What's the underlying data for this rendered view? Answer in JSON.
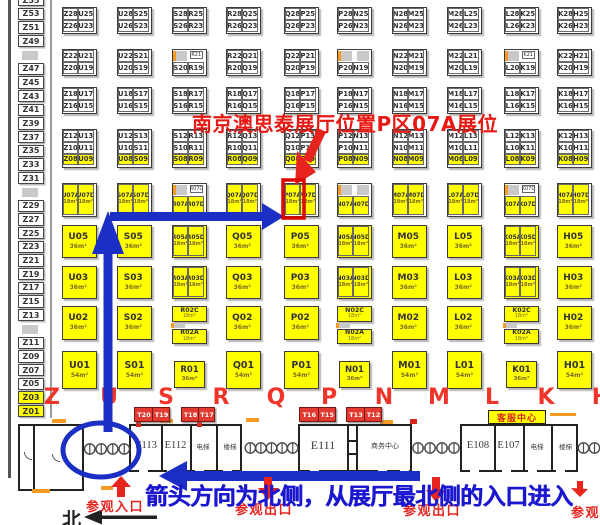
{
  "colors": {
    "booth_yellow": "#ffff00",
    "booth_border": "#3c3c3c",
    "gray_block": "#c9c9c9",
    "orange_mark": "#f59a23",
    "annotation_red": "#e8241f",
    "annotation_blue": "#1b2fc4",
    "letter_red": "#f0352b",
    "t_booth_red": "#e23a30"
  },
  "annotations": {
    "callout": "南京澳思泰展厅位置P区07A展位",
    "direction_note": "箭头方向为北侧，从展厅最北侧的入口进入",
    "entrance": "参观入口",
    "exit": "参观出口",
    "north": "北",
    "highlighted_booth": "P07A"
  },
  "z_column": [
    "Z55",
    "Z53",
    "Z51",
    "Z49",
    null,
    "Z47",
    "Z45",
    "Z43",
    "Z41",
    "Z39",
    "Z37",
    "Z35",
    "Z33",
    "Z31",
    null,
    "Z29",
    "Z27",
    "Z25",
    "Z23",
    "Z21",
    "Z19",
    "Z17",
    "Z15",
    "Z13",
    null,
    "Z11",
    "Z09",
    "Z07",
    "Z05",
    "Z03",
    "Z01"
  ],
  "grid": {
    "column_letters": [
      "Z",
      "U",
      "S",
      "R",
      "Q",
      "P",
      "N",
      "M",
      "L",
      "K",
      "H"
    ],
    "row1": [
      {
        "cells": [
          "Z28",
          "U25",
          "Z26",
          "U23"
        ]
      },
      {
        "cells": [
          "U28",
          "S25",
          "U26",
          "S23"
        ]
      },
      {
        "cells": [
          "S28",
          "R25",
          "S26",
          "R23"
        ]
      },
      {
        "cells": [
          "R28",
          "Q25",
          "R26",
          "Q23"
        ]
      },
      {
        "cells": [
          "Q28",
          "P25",
          "Q26",
          "P23"
        ]
      },
      {
        "cells": [
          "P28",
          "N25",
          "P26",
          "N23"
        ]
      },
      {
        "cells": [
          "N28",
          "M25",
          "N26",
          "M23"
        ]
      },
      {
        "cells": [
          "M28",
          "L25",
          "M26",
          "L23"
        ]
      },
      {
        "cells": [
          "L28",
          "K25",
          "L26",
          "K23"
        ]
      },
      {
        "cells": [
          "K28",
          "H25",
          "K26",
          "H23"
        ]
      }
    ],
    "row2": [
      {
        "cells": [
          "Z22",
          "U21",
          "Z20",
          "U19"
        ]
      },
      {
        "cells": [
          "U22",
          "S21",
          "U20",
          "S19"
        ]
      },
      {
        "cells": [
          null,
          null,
          "S20",
          "R19"
        ],
        "gray": [
          0
        ],
        "tag": "R21"
      },
      {
        "cells": [
          "R22",
          "Q21",
          "R20",
          "Q19"
        ]
      },
      {
        "cells": [
          "Q22",
          "P21",
          "Q20",
          "P19"
        ]
      },
      {
        "cells": [
          null,
          null,
          "P20",
          "N19"
        ],
        "gray": [
          0,
          1
        ]
      },
      {
        "cells": [
          "N22",
          "M21",
          "N20",
          "M19"
        ]
      },
      {
        "cells": [
          "M22",
          "L21",
          "M20",
          "L19"
        ]
      },
      {
        "cells": [
          null,
          null,
          "L20",
          "K19"
        ],
        "gray": [
          0
        ],
        "tag": "K21"
      },
      {
        "cells": [
          "K22",
          "H21",
          "K20",
          "H19"
        ]
      }
    ],
    "row3": [
      {
        "cells": [
          "Z18",
          "U17",
          "Z16",
          "U15"
        ]
      },
      {
        "cells": [
          "U18",
          "S17",
          "U16",
          "S15"
        ]
      },
      {
        "cells": [
          "S18",
          "R17",
          "S16",
          "R15"
        ]
      },
      {
        "cells": [
          "R18",
          "Q17",
          "R16",
          "Q15"
        ]
      },
      {
        "cells": [
          "Q18",
          "P17",
          "Q16",
          "P15"
        ]
      },
      {
        "cells": [
          "P18",
          "N17",
          "P16",
          "N15"
        ]
      },
      {
        "cells": [
          "N18",
          "M17",
          "N16",
          "M15"
        ]
      },
      {
        "cells": [
          "M18",
          "L17",
          "M16",
          "L15"
        ]
      },
      {
        "cells": [
          "L18",
          "K17",
          "L16",
          "K15"
        ]
      },
      {
        "cells": [
          "K18",
          "H17",
          "K16",
          "H15"
        ]
      }
    ],
    "row4": [
      {
        "cells": [
          "Z12",
          "U13",
          "Z10",
          "U11",
          "Z08",
          "U09"
        ]
      },
      {
        "cells": [
          "U12",
          "S13",
          "U10",
          "S11",
          "U08",
          "S09"
        ]
      },
      {
        "cells": [
          "S12",
          "R13",
          "S10",
          "R11",
          "S08",
          "R09"
        ]
      },
      {
        "cells": [
          "R12",
          "Q13",
          "R10",
          "Q11",
          "R08",
          "Q09"
        ]
      },
      {
        "cells": [
          "Q12",
          "P13",
          "Q10",
          "P11",
          "Q08",
          "P09"
        ]
      },
      {
        "cells": [
          "P12",
          "N13",
          "P10",
          "N11",
          "P08",
          "N09"
        ]
      },
      {
        "cells": [
          "N12",
          "M13",
          "N10",
          "M11",
          "N08",
          "M09"
        ]
      },
      {
        "cells": [
          "M12",
          "L13",
          "M10",
          "L11",
          "M08",
          "L09"
        ]
      },
      {
        "cells": [
          "L12",
          "K13",
          "L10",
          "K11",
          "L08",
          "K09"
        ]
      },
      {
        "cells": [
          "K12",
          "H13",
          "K10",
          "H11",
          "K08",
          "H09"
        ]
      }
    ],
    "row5": [
      {
        "t": "pair",
        "a": "U07A",
        "d": "U07D",
        "area": "18m²"
      },
      {
        "t": "pair",
        "a": "S07A",
        "d": "S07D",
        "area": "18m²"
      },
      {
        "t": "graytop",
        "tag": "R07C",
        "a": "R07A",
        "d": "R07D"
      },
      {
        "t": "pair",
        "a": "Q07A",
        "d": "Q07D",
        "area": "18m²"
      },
      {
        "t": "pair",
        "a": "P07A",
        "d": "P07D",
        "area": "18m²",
        "highlight": true
      },
      {
        "t": "graytop2",
        "a": "N07A",
        "d": "N07D"
      },
      {
        "t": "pair",
        "a": "M07A",
        "d": "M07D",
        "area": "18m²"
      },
      {
        "t": "pair",
        "a": "L07A",
        "d": "L07D",
        "area": "18m²"
      },
      {
        "t": "graytop",
        "tag": "K07C",
        "a": "K07A",
        "d": "K07D"
      },
      {
        "t": "pair",
        "a": "H07A",
        "d": "H07D",
        "area": "18m²"
      }
    ],
    "row6": [
      {
        "t": "single",
        "l": "U05",
        "area": "36m²"
      },
      {
        "t": "single",
        "l": "S05",
        "area": "36m²"
      },
      {
        "t": "pair",
        "a": "R05A",
        "d": "R05D",
        "area": "18m²"
      },
      {
        "t": "single",
        "l": "Q05",
        "area": "36m²"
      },
      {
        "t": "single",
        "l": "P05",
        "area": "36m²"
      },
      {
        "t": "pair",
        "a": "N05A",
        "d": "N05D",
        "area": "18m²"
      },
      {
        "t": "single",
        "l": "M05",
        "area": "36m²"
      },
      {
        "t": "single",
        "l": "L05",
        "area": "36m²"
      },
      {
        "t": "pair",
        "a": "K05A",
        "d": "K05D",
        "area": "18m²"
      },
      {
        "t": "single",
        "l": "H05",
        "area": "36m²"
      }
    ],
    "row7": [
      {
        "t": "single",
        "l": "U03",
        "area": "36m²"
      },
      {
        "t": "single",
        "l": "S03",
        "area": "36m²"
      },
      {
        "t": "pair",
        "a": "R03A",
        "d": "R03D",
        "area": "18m²"
      },
      {
        "t": "single",
        "l": "Q03",
        "area": "36m²"
      },
      {
        "t": "single",
        "l": "P03",
        "area": "36m²"
      },
      {
        "t": "pair",
        "a": "N03A",
        "d": "N03D",
        "area": "18m²"
      },
      {
        "t": "single",
        "l": "M03",
        "area": "36m²"
      },
      {
        "t": "single",
        "l": "L03",
        "area": "36m²"
      },
      {
        "t": "pair",
        "a": "K03A",
        "d": "K03D",
        "area": "18m²"
      },
      {
        "t": "single",
        "l": "H03",
        "area": "36m²"
      }
    ],
    "row8": [
      {
        "t": "single",
        "l": "U02",
        "area": "36m²"
      },
      {
        "t": "single",
        "l": "S02",
        "area": "36m²"
      },
      {
        "t": "stack",
        "top": "R02C",
        "bottom": "R02A",
        "area": "18m²"
      },
      {
        "t": "single",
        "l": "Q02",
        "area": "36m²"
      },
      {
        "t": "single",
        "l": "P02",
        "area": "36m²"
      },
      {
        "t": "stack",
        "top": "N02C",
        "bottom": "N02A",
        "area": "18m²"
      },
      {
        "t": "single",
        "l": "M02",
        "area": "36m²"
      },
      {
        "t": "single",
        "l": "L02",
        "area": "36m²"
      },
      {
        "t": "stack",
        "top": "K02C",
        "bottom": "K02A",
        "area": "18m²"
      },
      {
        "t": "single",
        "l": "H02",
        "area": "36m²"
      }
    ],
    "row9": [
      {
        "t": "single",
        "l": "U01",
        "area": "54m²"
      },
      {
        "t": "single",
        "l": "S01",
        "area": "54m²"
      },
      {
        "t": "small",
        "l": "R01",
        "area": "36m²"
      },
      {
        "t": "single",
        "l": "Q01",
        "area": "54m²"
      },
      {
        "t": "single",
        "l": "P01",
        "area": "54m²"
      },
      {
        "t": "small",
        "l": "N01",
        "area": "36m²"
      },
      {
        "t": "single",
        "l": "M01",
        "area": "54m²"
      },
      {
        "t": "single",
        "l": "L01",
        "area": "54m²"
      },
      {
        "t": "small",
        "l": "K01",
        "area": "36m²"
      },
      {
        "t": "single",
        "l": "H01",
        "area": "54m²"
      }
    ]
  },
  "t_booths": [
    [
      "T20",
      "T19"
    ],
    [
      "T18",
      "T17"
    ],
    [
      "T16",
      "T15"
    ],
    [
      "T13",
      "T12"
    ]
  ],
  "bottom": {
    "service_center": "客服中心",
    "left_rooms": [
      "E113",
      "E112",
      "电梯",
      "楼梯"
    ],
    "mid_rooms": [
      "E111",
      "商务中心"
    ],
    "right_rooms": [
      "E108",
      "E107",
      "电梯",
      "楼梯"
    ]
  }
}
